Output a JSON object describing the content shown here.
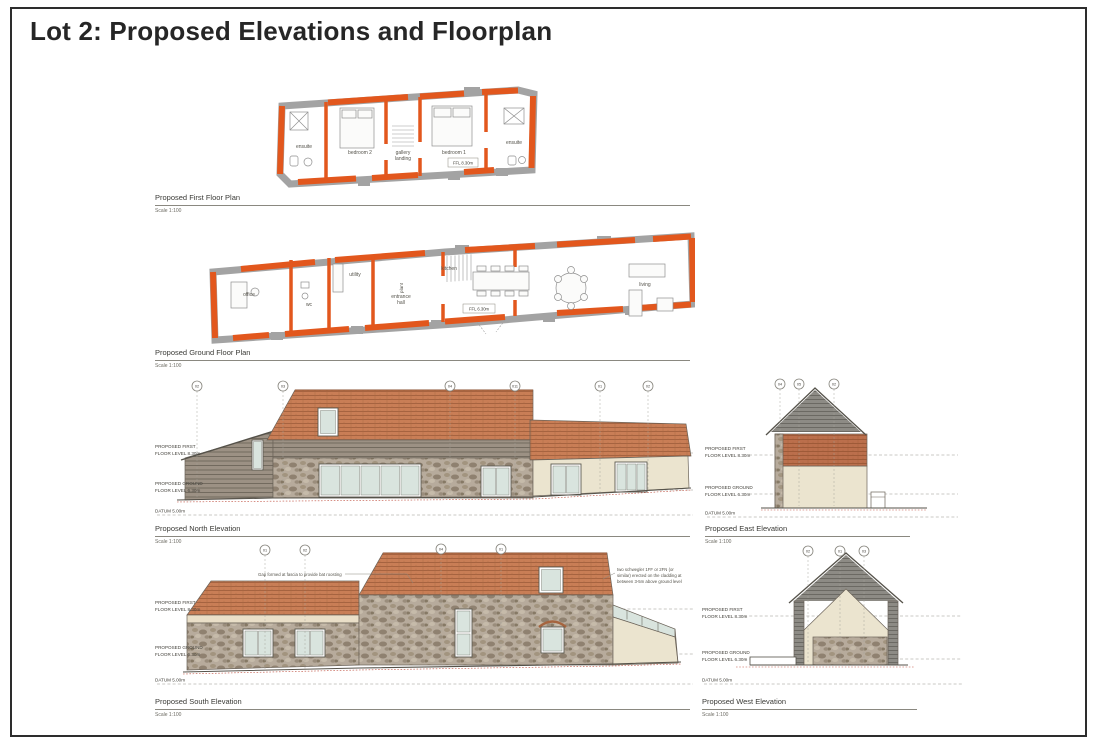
{
  "page": {
    "title": "Lot 2: Proposed Elevations and Floorplan"
  },
  "palette": {
    "new_work_orange": "#e2571d",
    "existing_wall_grey": "#a3a3a3",
    "roof_terracotta": "#c97e56",
    "timber_cladding_grey": "#9c9184",
    "slate_cladding_grey": "#8d8b85",
    "stone": "#b7ab9c",
    "render_cream": "#ebe4cf",
    "glazing": "#d9e4de",
    "existing_ground_red": "#bf4e3e"
  },
  "first_floor_plan": {
    "title": "Proposed First Floor Plan",
    "scale": "Scale 1:100",
    "level_tag": "FFL 8.30m",
    "rooms": {
      "ensuite_left": "ensuite",
      "bedroom2": "bedroom 2",
      "gallery_l1": "gallery",
      "gallery_l2": "landing",
      "bedroom1": "bedroom 1",
      "ensuite_right": "ensuite"
    }
  },
  "ground_floor_plan": {
    "title": "Proposed Ground Floor Plan",
    "scale": "Scale 1:100",
    "level_tag": "FFL 6.30m",
    "rooms": {
      "office": "office",
      "wc": "wc",
      "utility": "utility",
      "plant": "plant",
      "hall_l1": "entrance",
      "hall_l2": "hall",
      "kitchen": "kitchen",
      "living": "living"
    }
  },
  "north_elevation": {
    "title": "Proposed North Elevation",
    "scale": "Scale 1:100",
    "levels": {
      "first_l1": "PROPOSED FIRST",
      "first_l2": "FLOOR LEVEL 8.30m",
      "ground_l1": "PROPOSED GROUND",
      "ground_l2": "FLOOR LEVEL 6.30m",
      "datum": "DATUM 5.00m"
    },
    "markers": [
      "02",
      "03",
      "04",
      "011",
      "01",
      "02"
    ]
  },
  "east_elevation": {
    "title": "Proposed East Elevation",
    "scale": "Scale 1:100",
    "levels": {
      "first_l1": "PROPOSED FIRST",
      "first_l2": "FLOOR LEVEL 8.30m",
      "ground_l1": "PROPOSED GROUND",
      "ground_l2": "FLOOR LEVEL 6.30m",
      "datum": "DATUM 5.00m"
    },
    "markers": [
      "04",
      "05",
      "02"
    ]
  },
  "south_elevation": {
    "title": "Proposed South Elevation",
    "scale": "Scale 1:100",
    "levels": {
      "first_l1": "PROPOSED FIRST",
      "first_l2": "FLOOR LEVEL 8.30m",
      "ground_l1": "PROPOSED GROUND",
      "ground_l2": "FLOOR LEVEL 6.30m",
      "datum": "DATUM 5.00m"
    },
    "markers": [
      "01",
      "02",
      "04",
      "01"
    ],
    "note_bat": "Gap formed at fascia to provide bat roosting",
    "note_boxes": [
      "two schwegler 1FF or 2FN (or",
      "similar) erected on the cladding at",
      "between 3-5m above ground level"
    ]
  },
  "west_elevation": {
    "title": "Proposed West Elevation",
    "scale": "Scale 1:100",
    "levels": {
      "first_l1": "PROPOSED FIRST",
      "first_l2": "FLOOR LEVEL 8.30m",
      "ground_l1": "PROPOSED GROUND",
      "ground_l2": "FLOOR LEVEL 6.30m",
      "datum": "DATUM 5.00m"
    },
    "markers": [
      "02",
      "01",
      "03"
    ]
  }
}
